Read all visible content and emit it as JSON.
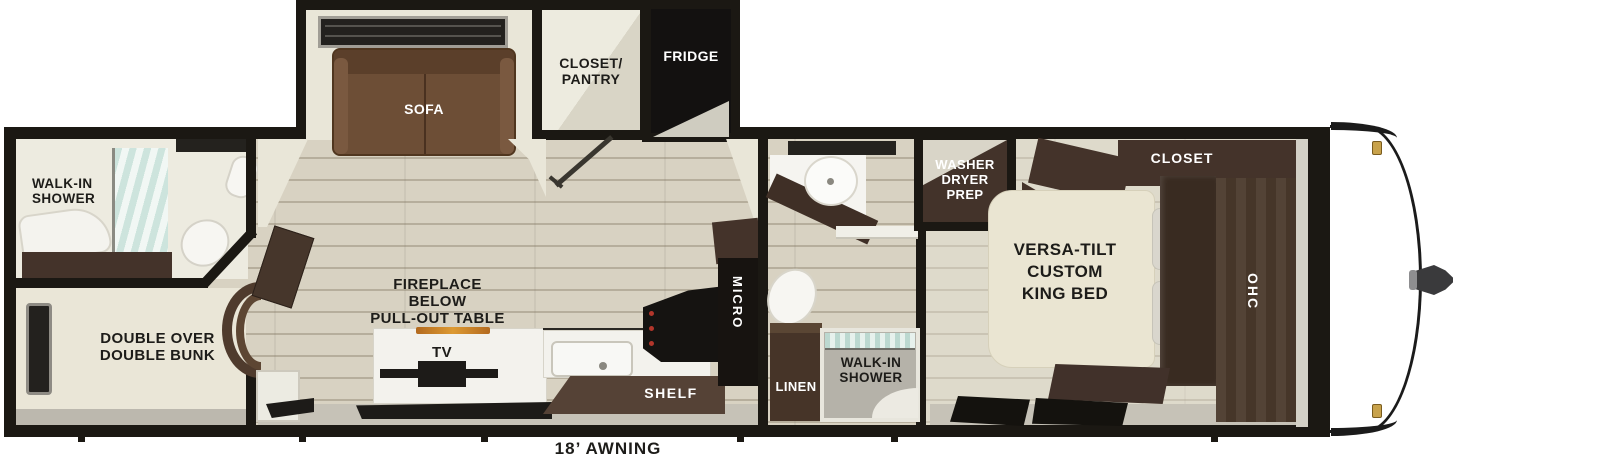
{
  "labels": {
    "sofa": "SOFA",
    "closet_pantry": "CLOSET/\nPANTRY",
    "fridge": "FRIDGE",
    "rear_shower": "WALK-IN\nSHOWER",
    "bunk": "DOUBLE OVER\nDOUBLE BUNK",
    "fireplace": "FIREPLACE\nBELOW\nPULL-OUT TABLE",
    "tv": "TV",
    "shelf": "SHELF",
    "micro": "MICRO",
    "linen": "LINEN",
    "mid_shower": "WALK-IN\nSHOWER",
    "washer_dryer": "WASHER\nDRYER\nPREP",
    "king_bed": "VERSA-TILT\nCUSTOM\nKING BED",
    "closet": "CLOSET",
    "ohc": "OHC",
    "awning": "18’ AWNING"
  },
  "colors": {
    "wall": "#1b1813",
    "floor": "#d8d2c2",
    "beige_wall": "#e9e6d8",
    "cabinet_dark": "#44332a",
    "cabinet_mid": "#554236",
    "sofa_brown": "#6d4e36",
    "bed_cream": "#eae5d2",
    "glass_teal": "#cde4dd",
    "accent_amber": "#dd9a33",
    "marker_gold": "#c8a24b",
    "label_dark": "#1d1c19",
    "label_light": "#ffffff"
  }
}
